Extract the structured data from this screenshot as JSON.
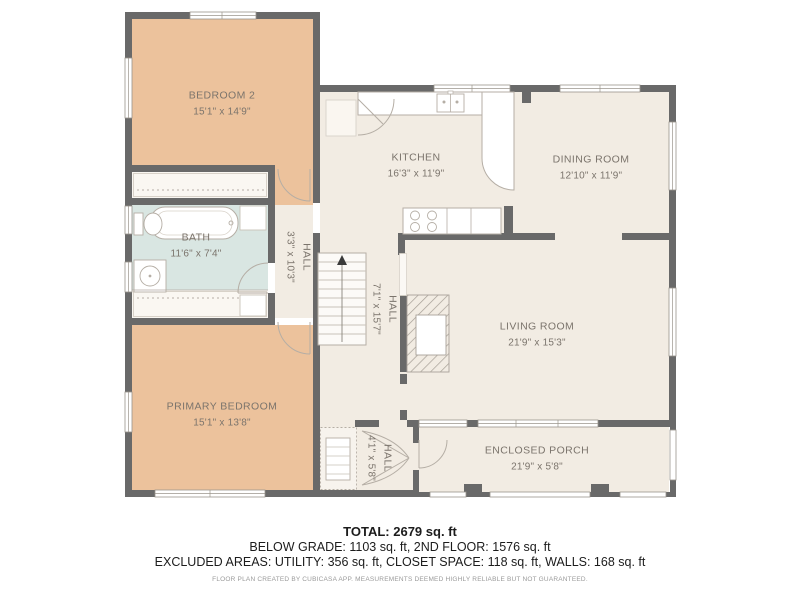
{
  "title": "CubiCasa second floor plan",
  "rooms": {
    "bedroom2": {
      "name": "BEDROOM 2",
      "dims": "15'1\" x 14'9\""
    },
    "kitchen": {
      "name": "KITCHEN",
      "dims": "16'3\" x 11'9\""
    },
    "dining": {
      "name": "DINING ROOM",
      "dims": "12'10\" x 11'9\""
    },
    "bath": {
      "name": "BATH",
      "dims": "11'6\" x 7'4\""
    },
    "hall_upper": {
      "name": "HALL",
      "dims": "3'3\" x 10'3\""
    },
    "hall_main": {
      "name": "HALL",
      "dims": "7'1\" x 15'7\""
    },
    "living": {
      "name": "LIVING ROOM",
      "dims": "21'9\" x 15'3\""
    },
    "primary": {
      "name": "PRIMARY BEDROOM",
      "dims": "15'1\" x 13'8\""
    },
    "hall_lower": {
      "name": "HALL",
      "dims": "4'1\" x 5'8\""
    },
    "porch": {
      "name": "ENCLOSED PORCH",
      "dims": "21'9\" x 5'8\""
    }
  },
  "summary": {
    "total": "TOTAL: 2679 sq. ft",
    "floors": "BELOW GRADE: 1103 sq. ft, 2ND FLOOR: 1576 sq. ft",
    "excluded": "EXCLUDED AREAS: UTILITY: 356 sq. ft, CLOSET SPACE: 118 sq. ft, WALLS: 168 sq. ft",
    "disclaimer": "FLOOR PLAN CREATED BY CUBICASA APP. MEASUREMENTS DEEMED HIGHLY RELIABLE BUT NOT GUARANTEED."
  },
  "colors": {
    "wall": "#696969",
    "bedroom_fill": "#ecc29c",
    "room_fill": "#f2ece3",
    "bath_fill": "#d9e6e2",
    "closet_fill": "#faf7f2",
    "label_text": "#7b746c",
    "fixture_stroke": "#b5aea5"
  }
}
